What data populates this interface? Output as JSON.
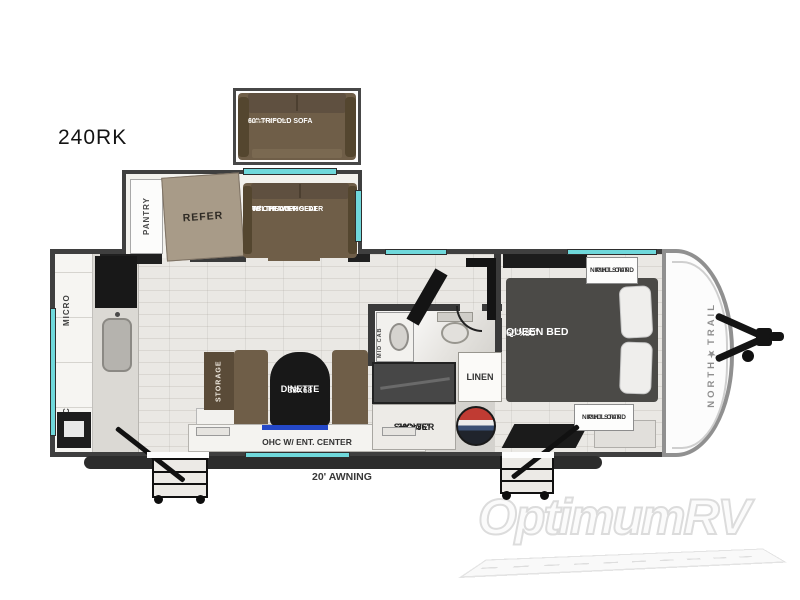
{
  "model": "240RK",
  "slideouts": {
    "sofa": {
      "line1": "60\" TRIFOLD SOFA",
      "line2": "SLEEP: 47\"x73\""
    },
    "pantry_label": "PANTRY",
    "refer_label": "REFER",
    "theater": {
      "line1": "60\" THEATER SEAT",
      "line2": "W/ OPT CUPHOLDER",
      "line3": "TBL TRAYS"
    }
  },
  "kitchen": {
    "micro_label": "MICRO",
    "ohc_label": "OHC"
  },
  "dinette": {
    "storage_label": "STORAGE",
    "name": "DINETTE",
    "size": "38X68",
    "ent_label": "OHC W/ ENT. CENTER"
  },
  "bathroom": {
    "mid_cab_label": "MID CAB",
    "linen_label": "LINEN",
    "shower_size": "30\"x36\"",
    "shower_label": "SHOWER"
  },
  "bedroom": {
    "bed_name": "QUEEN BED",
    "bed_size": "60\"x80\"",
    "nightstand_line1": "PULL OUT",
    "nightstand_line2": "NIGHT STAND"
  },
  "exterior": {
    "awning_label": "20' AWNING",
    "brand": "NORTH★TRAIL"
  },
  "watermark": {
    "text": "OptimumRV"
  },
  "colors": {
    "accent_window": "#6fd8db",
    "wall": "#3f3f3f",
    "furniture_brown": "#6f5e48",
    "bed_gray": "#4b4a47",
    "tv_blue": "#2448c8",
    "accessory_red": "#c03b33"
  }
}
